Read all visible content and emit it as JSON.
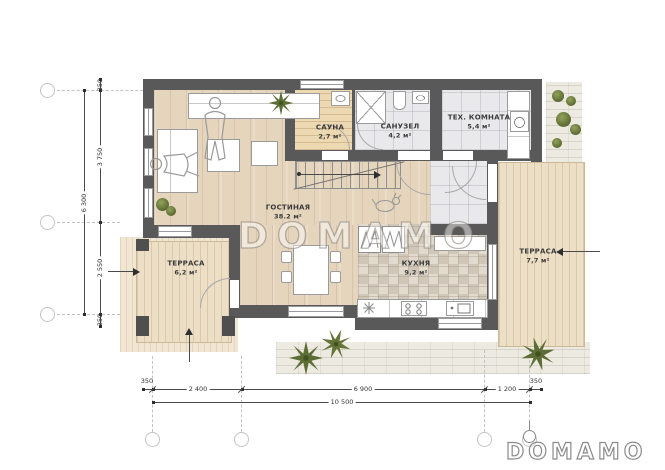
{
  "watermark_text": "DOMAMO",
  "brand_logo_text": "DOMAMO",
  "rooms": {
    "living": {
      "name": "ГОСТИНАЯ",
      "area": "38.2 м²"
    },
    "sauna": {
      "name": "САУНА",
      "area": "2,7 м²"
    },
    "bathroom": {
      "name": "САНУЗЕЛ",
      "area": "4,2 м²"
    },
    "tech": {
      "name": "ТЕХ. КОМНАТА",
      "area": "5,4 м²"
    },
    "kitchen": {
      "name": "КУХНЯ",
      "area": "9,2 м²"
    },
    "terrace_left": {
      "name": "ТЕРРАСА",
      "area": "6,2 м²"
    },
    "terrace_right": {
      "name": "ТЕРРАСА",
      "area": "7,7 м²"
    }
  },
  "dimensions": {
    "left": [
      "350",
      "3 750",
      "6 300",
      "2 550",
      "350"
    ],
    "bottom": [
      "350",
      "2 400",
      "6 900",
      "1 200",
      "350",
      "10 500"
    ]
  },
  "palette": {
    "wall": "#595959",
    "wood_floor": "#e6d5bd",
    "terrace_deck": "#ecdfc6",
    "tile": "#e9e9eb",
    "kitchen_mosaic": "#e2dacd",
    "sauna_wood": "#ecd9b2",
    "stone_path": "#edeae1",
    "plant_green": "#5c6d35",
    "dimension_text": "#333333"
  }
}
